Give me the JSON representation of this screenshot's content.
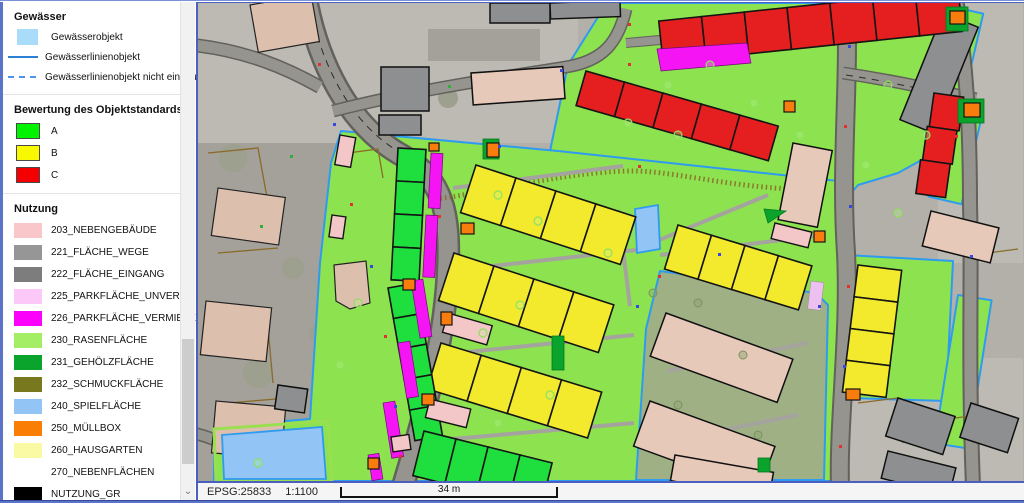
{
  "legend": {
    "sections": {
      "gewaesser": {
        "title": "Gewässer",
        "items": [
          {
            "label": "Gewässerobjekt",
            "symbol": "area",
            "color": "#a8dcf8"
          },
          {
            "label": "Gewässerlinienobjekt",
            "symbol": "line",
            "color": "#2e7fd6"
          },
          {
            "label": "Gewässerlinienobjekt nicht eindeutig",
            "symbol": "dashed-line",
            "color": "#4f94e8"
          }
        ]
      },
      "bewertung": {
        "title": "Bewertung des Objektstandards",
        "items": [
          {
            "label": "A",
            "color": "#00f400"
          },
          {
            "label": "B",
            "color": "#f8f800"
          },
          {
            "label": "C",
            "color": "#f40000"
          }
        ]
      },
      "nutzung": {
        "title": "Nutzung",
        "items": [
          {
            "label": "203_NEBENGEBÄUDE",
            "color": "#f9c6c9"
          },
          {
            "label": "221_FLÄCHE_WEGE",
            "color": "#969696"
          },
          {
            "label": "222_FLÄCHE_EINGANG",
            "color": "#7d7d7d"
          },
          {
            "label": "225_PARKFLÄCHE_UNVERM",
            "color": "#fbc8f7"
          },
          {
            "label": "226_PARKFLÄCHE_VERMIETET",
            "color": "#fb00fb"
          },
          {
            "label": "230_RASENFLÄCHE",
            "color": "#a4ee66"
          },
          {
            "label": "231_GEHÖLZFLÄCHE",
            "color": "#0aa32b"
          },
          {
            "label": "232_SCHMUCKFLÄCHE",
            "color": "#78781e"
          },
          {
            "label": "240_SPIELFLÄCHE",
            "color": "#92c4f6"
          },
          {
            "label": "250_MÜLLBOX",
            "color": "#fa7d05"
          },
          {
            "label": "260_HAUSGARTEN",
            "color": "#fafaa5"
          },
          {
            "label": "270_NEBENFLÄCHEN",
            "color": "#ffffff"
          },
          {
            "label": "NUTZUNG_GR",
            "color": "#000000"
          }
        ]
      }
    },
    "icons": {
      "scroll_down": "⌄"
    }
  },
  "statusbar": {
    "epsg": "EPSG:25833",
    "scale": "1:1100",
    "scalebar_label": "34 m"
  },
  "map": {
    "palette": {
      "rasen": "#8ce24f",
      "bewa": "#1fdf3f",
      "bewb": "#f3ea2d",
      "bewc": "#e51f1f",
      "parkv": "#f414f4",
      "parku": "#eec0ef",
      "spiel": "#92c4f6",
      "muell": "#f97d0c",
      "nebeng": "#f3c6c8",
      "gehoelz": "#0aa32b",
      "wege": "#96948e",
      "roadedge": "#62615b",
      "photo": "#b2b0a8",
      "bldtan": "#e7c9ba",
      "bldgray": "#8e8f91",
      "brown": "#8a6a28",
      "waterline": "#2e7fd6",
      "waterline2": "#2e9bf0",
      "waterdash": "#4f94e8",
      "waterarea": "#a8dcf8"
    }
  }
}
